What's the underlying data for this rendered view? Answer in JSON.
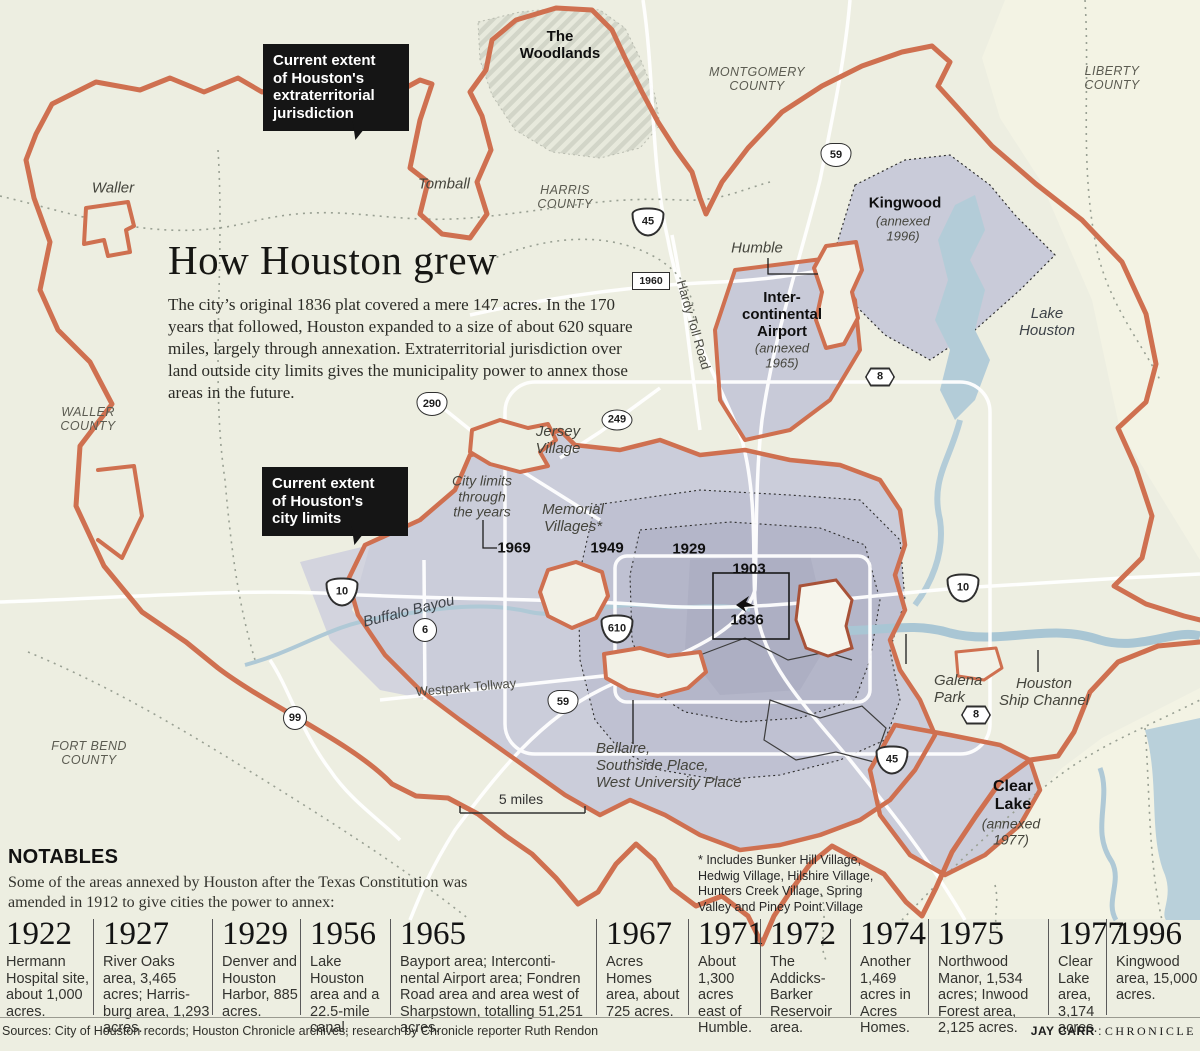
{
  "title": {
    "heading": "How Houston grew",
    "body": "The city’s original 1836 plat covered a mere 147 acres. In the 170 years that followed, Houston expanded to a size of about 620 square miles, largely through annexation. Extraterritorial jurisdiction over land outside city limits gives the municipality power to annex those areas in the future."
  },
  "notables": {
    "heading": "NOTABLES",
    "intro": "Some of the areas annexed by Houston after the Texas Constitution was amended in 1912 to give cities the power to annex:"
  },
  "footer": {
    "sources": "Sources: City of Houston records; Houston Chronicle archives; research by Chronicle reporter Ruth Rendon",
    "credit_name": "JAY CARR",
    "credit_sep": " : ",
    "credit_org": "CHRONICLE"
  },
  "colors": {
    "background": "#edeee1",
    "boundary_orange": "#cf7050",
    "city_lavender": "#cbcdda",
    "city_mid": "#bfc1d2",
    "city_inner": "#b4b6c9",
    "water_blue": "#b3ccd8",
    "callout_black": "#151515"
  },
  "map": {
    "callouts": [
      {
        "name": "etj-callout",
        "text": "Current extent\nof Houston's\nextraterritorial\njurisdiction",
        "x": 263,
        "y": 44,
        "w": 126
      },
      {
        "name": "city-limits-callout",
        "text": "Current extent\nof Houston's\ncity limits",
        "x": 262,
        "y": 467,
        "w": 126
      }
    ],
    "labels": [
      {
        "name": "label-the-woodlands",
        "text": "The\nWoodlands",
        "x": 560,
        "y": 46,
        "cls": "lbl-bold"
      },
      {
        "name": "label-montgomery-county",
        "text": "MONTGOMERY\nCOUNTY",
        "x": 757,
        "y": 79,
        "cls": "lbl-county"
      },
      {
        "name": "label-liberty-county",
        "text": "LIBERTY\nCOUNTY",
        "x": 1112,
        "y": 78,
        "cls": "lbl-county"
      },
      {
        "name": "label-waller",
        "text": "Waller",
        "x": 113,
        "y": 189,
        "cls": "lbl-it"
      },
      {
        "name": "label-tomball",
        "text": "Tomball",
        "x": 444,
        "y": 185,
        "cls": "lbl-it"
      },
      {
        "name": "label-harris-county",
        "text": "HARRIS\nCOUNTY",
        "x": 565,
        "y": 197,
        "cls": "lbl-county"
      },
      {
        "name": "label-kingwood",
        "text": "Kingwood",
        "x": 905,
        "y": 204,
        "cls": "lbl-bold"
      },
      {
        "name": "label-kingwood-annexed",
        "text": "(annexed\n1996)",
        "x": 903,
        "y": 229,
        "cls": "lbl-it13"
      },
      {
        "name": "label-humble",
        "text": "Humble",
        "x": 757,
        "y": 249,
        "cls": "lbl-it"
      },
      {
        "name": "label-intercontinental",
        "text": "Inter-\ncontinental\nAirport",
        "x": 782,
        "y": 315,
        "cls": "lbl-bold"
      },
      {
        "name": "label-intercontinental-annexed",
        "text": "(annexed\n1965)",
        "x": 782,
        "y": 356,
        "cls": "lbl-it13"
      },
      {
        "name": "label-lake-houston",
        "text": "Lake\nHouston",
        "x": 1047,
        "y": 323,
        "cls": "lbl-water"
      },
      {
        "name": "label-waller-county",
        "text": "WALLER\nCOUNTY",
        "x": 88,
        "y": 419,
        "cls": "lbl-county"
      },
      {
        "name": "label-jersey-village",
        "text": "Jersey\nVillage",
        "x": 558,
        "y": 441,
        "cls": "lbl-it"
      },
      {
        "name": "label-city-limits-through",
        "text": "City limits\nthrough\nthe years",
        "x": 482,
        "y": 497,
        "cls": "lbl-it14"
      },
      {
        "name": "label-year-1969",
        "text": "1969",
        "x": 514,
        "y": 549,
        "cls": "lbl-year"
      },
      {
        "name": "label-memorial-villages",
        "text": "Memorial\nVillages*",
        "x": 573,
        "y": 519,
        "cls": "lbl-it"
      },
      {
        "name": "label-year-1949",
        "text": "1949",
        "x": 607,
        "y": 549,
        "cls": "lbl-year"
      },
      {
        "name": "label-year-1929",
        "text": "1929",
        "x": 689,
        "y": 550,
        "cls": "lbl-year"
      },
      {
        "name": "label-year-1903",
        "text": "1903",
        "x": 749,
        "y": 570,
        "cls": "lbl-year"
      },
      {
        "name": "label-year-1836",
        "text": "1836",
        "x": 747,
        "y": 621,
        "cls": "lbl-year"
      },
      {
        "name": "label-buffalo-bayou",
        "text": "Buffalo Bayou",
        "x": 409,
        "y": 612,
        "cls": "lbl-water",
        "rot": -14
      },
      {
        "name": "label-westpark-tollway",
        "text": "Westpark Tollway",
        "x": 466,
        "y": 688,
        "cls": "lbl-road",
        "rot": -5
      },
      {
        "name": "label-hardy-toll-road",
        "text": "Hardy Toll Road",
        "x": 693,
        "y": 325,
        "cls": "lbl-road",
        "rot": 74
      },
      {
        "name": "label-galena-park",
        "text": "Galena\nPark",
        "x": 934,
        "y": 690,
        "cls": "lbl-it lbl-left",
        "anchor": "left",
        "x2": 912
      },
      {
        "name": "label-houston-ship-channel",
        "text": "Houston\nShip Channel",
        "x": 1044,
        "y": 693,
        "cls": "lbl-it"
      },
      {
        "name": "label-bellaire",
        "text": "Bellaire,\nSouthside Place,\nWest University Place",
        "x": 596,
        "y": 766,
        "cls": "lbl-it lbl-left",
        "anchor": "left"
      },
      {
        "name": "label-clear-lake",
        "text": "Clear\nLake",
        "x": 1013,
        "y": 796,
        "cls": "lbl-bold16"
      },
      {
        "name": "label-clear-lake-annexed",
        "text": "(annexed\n1977)",
        "x": 1011,
        "y": 832,
        "cls": "lbl-it14"
      },
      {
        "name": "label-fort-bend-county",
        "text": "FORT BEND\nCOUNTY",
        "x": 89,
        "y": 753,
        "cls": "lbl-county"
      },
      {
        "name": "label-scale",
        "text": "5 miles",
        "x": 521,
        "y": 800,
        "cls": "lbl-scale"
      },
      {
        "name": "label-villages-footnote",
        "text": "* Includes Bunker Hill Village,\nHedwig Village, Hilshire Village,\nHunters Creek Village, Spring\nValley and Piney Point Village",
        "x": 698,
        "y": 884,
        "cls": "lbl-foot lbl-left",
        "anchor": "left"
      }
    ],
    "shields": [
      {
        "t": "us",
        "n": "59",
        "x": 836,
        "y": 155
      },
      {
        "t": "i",
        "n": "45",
        "x": 648,
        "y": 222
      },
      {
        "t": "rect",
        "n": "1960",
        "x": 651,
        "y": 281
      },
      {
        "t": "us",
        "n": "290",
        "x": 432,
        "y": 404
      },
      {
        "t": "oval",
        "n": "249",
        "x": 617,
        "y": 420
      },
      {
        "t": "i",
        "n": "10",
        "x": 342,
        "y": 592
      },
      {
        "t": "circle",
        "n": "6",
        "x": 425,
        "y": 630
      },
      {
        "t": "i",
        "n": "610",
        "x": 617,
        "y": 629
      },
      {
        "t": "us",
        "n": "59",
        "x": 563,
        "y": 702
      },
      {
        "t": "circle",
        "n": "99",
        "x": 295,
        "y": 718
      },
      {
        "t": "i",
        "n": "45",
        "x": 892,
        "y": 760
      },
      {
        "t": "i",
        "n": "10",
        "x": 963,
        "y": 588
      },
      {
        "t": "hex",
        "n": "8",
        "x": 880,
        "y": 377
      },
      {
        "t": "hex",
        "n": "8",
        "x": 976,
        "y": 715
      }
    ]
  },
  "timeline": {
    "entries": [
      {
        "year": "1922",
        "text": "Hermann Hospital site, about 1,000 acres.",
        "left": 6,
        "width": 84
      },
      {
        "year": "1927",
        "text": "River Oaks area, 3,465 acres; Harris-burg area, 1,293 acres.",
        "left": 93,
        "width": 108
      },
      {
        "year": "1929",
        "text": "Denver and Houston Harbor, 885 acres.",
        "left": 212,
        "width": 78
      },
      {
        "year": "1956",
        "text": "Lake Houston area and a 22.5-mile canal.",
        "left": 300,
        "width": 80
      },
      {
        "year": "1965",
        "text": "Bayport area; Interconti-nental Airport area; Fondren Road area and area west of Sharpstown, totalling 51,251 acres.",
        "left": 390,
        "width": 194
      },
      {
        "year": "1967",
        "text": "Acres Homes area, about 725 acres.",
        "left": 596,
        "width": 82
      },
      {
        "year": "1971",
        "text": "About 1,300 acres east of Humble.",
        "left": 688,
        "width": 62
      },
      {
        "year": "1972",
        "text": "The Addicks-Barker Reservoir area.",
        "left": 760,
        "width": 80
      },
      {
        "year": "1974",
        "text": "Another 1,469 acres in Acres Homes.",
        "left": 850,
        "width": 68
      },
      {
        "year": "1975",
        "text": "Northwood Manor, 1,534 acres; Inwood Forest area, 2,125 acres.",
        "left": 928,
        "width": 110
      },
      {
        "year": "1977",
        "text": "Clear Lake area, 3,174 acres.",
        "left": 1048,
        "width": 50
      },
      {
        "year": "1996",
        "text": "Kingwood area, 15,000 acres.",
        "left": 1106,
        "width": 88
      }
    ]
  }
}
